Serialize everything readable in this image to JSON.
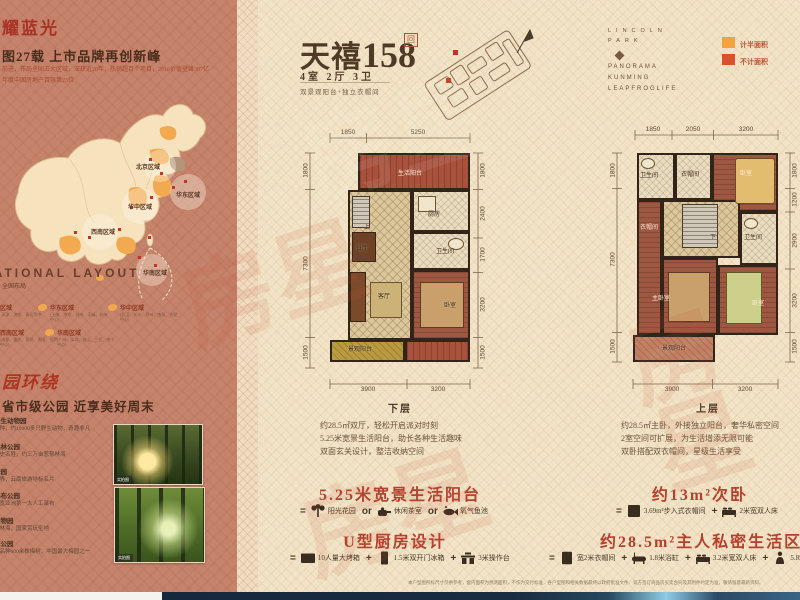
{
  "sidebar": {
    "brand_heading": "耀蓝光",
    "headline": "图27载 上市品牌再创新峰",
    "subline1": "前进，布局全国五大区域，深耕近20年，热销超百个项目，2016价值登峰307亿",
    "subline2": "年度中国房地产百强第23位",
    "map": {
      "layout_en": "NATIONAL LAYOUT",
      "layout_cn": "全国布局",
      "map_labels": [
        "北京区域",
        "华东区域",
        "华中区域",
        "西南区域",
        "华南区域"
      ],
      "legend": [
        {
          "name": "北京区域",
          "desc": "(北京、天津、济南、青岛等中心)"
        },
        {
          "name": "华东区域",
          "desc": "(上海、南京、苏州、无锡、杭州中心)"
        },
        {
          "name": "华中区域",
          "desc": "(武汉、长沙、郑州、南昌、合肥中心)"
        },
        {
          "name": "西南区域",
          "desc": "(成都、重庆、昆明、贵阳、拉萨中心)"
        },
        {
          "name": "华南区域",
          "desc": "(广州、深圳、佛山、三亚、南宁中心)"
        }
      ]
    },
    "park_script": "园环绕",
    "park_headline": "省市级公园  近享美好周末",
    "parks": [
      {
        "name": "野生动物园",
        "desc": "多种，约10000多只野生动物，奇趣非凡"
      },
      {
        "name": "森林公园",
        "desc": "历史名胜，约三万亩葱郁林海"
      },
      {
        "name": "公园",
        "desc": "世界，云南旅游地标名片"
      },
      {
        "name": "瀑布公园",
        "desc": "米宽亚洲第一大人工瀑布"
      },
      {
        "name": "植物园",
        "desc": "杏林海，国家赏玩圣地"
      },
      {
        "name": "潭公园",
        "desc": "个品种600余株梅树，中国最大梅园之一"
      }
    ],
    "photo_tag": "实拍图"
  },
  "main": {
    "title": "天禧",
    "title_num": "158",
    "seal": "回",
    "spec": "4室 2厅 3卫",
    "tagline": "双景观阳台+独立衣帽间",
    "brand": {
      "top1": "LINCOLN",
      "top2": "PARK",
      "line1": "PANORAMA",
      "line2": "KUNMING",
      "line3": "LEAPFROGLIFE"
    },
    "area_legend": [
      {
        "label": "计半面积",
        "color": "#f2a33c"
      },
      {
        "label": "不计面积",
        "color": "#d8502c"
      }
    ],
    "plans": [
      {
        "floor_label": "下层",
        "dims_top": [
          "1850",
          "5250"
        ],
        "dims_left": [
          "1800",
          "7300",
          "1500"
        ],
        "dims_right": [
          "1800",
          "2400",
          "1700",
          "3200",
          "1500"
        ],
        "dims_bottom": [
          "3900",
          "3200"
        ],
        "rooms": [
          "生活阳台",
          "厨房",
          "卫生间",
          "餐厅",
          "客厅",
          "卧室",
          "景观阳台",
          "上"
        ],
        "desc1": "约28.5㎡双厅，轻松开启派对时刻",
        "desc2": "5.25米宽景生活阳台，助长各种生活趣味",
        "desc3": "双面玄关设计，整洁收纳空间"
      },
      {
        "floor_label": "上层",
        "dims_top": [
          "1850",
          "2050",
          "3200"
        ],
        "dims_left": [
          "1800",
          "7300",
          "1500"
        ],
        "dims_right": [
          "1800",
          "1200",
          "2900",
          "3200",
          "1500"
        ],
        "dims_bottom": [
          "3900",
          "3200"
        ],
        "rooms": [
          "卫生间",
          "衣帽间",
          "卧室",
          "衣帽间",
          "下",
          "卫生间",
          "主卧室",
          "卧室",
          "景观阳台"
        ],
        "desc1": "约28.5㎡主卧，外接独立阳台，奢华私密空间",
        "desc2": "2室空间可扩展，为生活增添无限可能",
        "desc3": "双卧搭配双衣帽间，星级生活享受"
      }
    ],
    "features": [
      {
        "heading": "5.25米宽景生活阳台",
        "eq": "=",
        "op": "or",
        "items": [
          {
            "icon": "plant-icon",
            "label": "阳光花园"
          },
          {
            "icon": "teapot-icon",
            "label": "休闲茶室"
          },
          {
            "icon": "fish-icon",
            "label": "氧气鱼池"
          }
        ]
      },
      {
        "heading": "U型厨房设计",
        "eq": "=",
        "op": "+",
        "items": [
          {
            "icon": "oven-icon",
            "label": "10人量大烤箱"
          },
          {
            "icon": "fridge-icon",
            "label": "1.5米双开门冰箱"
          },
          {
            "icon": "counter-icon",
            "label": "3米操作台"
          }
        ]
      },
      {
        "heading": "约13m²次卧",
        "eq": "=",
        "op": "+",
        "items": [
          {
            "icon": "closet-icon",
            "label": "3.69m²步入式衣帽间"
          },
          {
            "icon": "bed-icon",
            "label": "2米宽双人床"
          }
        ]
      },
      {
        "heading": "约28.5m²主人私密生活区",
        "eq": "=",
        "op": "+",
        "items": [
          {
            "icon": "wardrobe-icon",
            "label": "宽2米衣帽间"
          },
          {
            "icon": "bathtub-icon",
            "label": "1.8米浴缸"
          },
          {
            "icon": "bed-icon",
            "label": "3.2米宽双人床"
          },
          {
            "icon": "person-icon",
            "label": "5.85m²私人空间"
          }
        ]
      }
    ],
    "disclaimer": "本户型图所标尺寸仅供参考，套内面积为预测面积，不作为交付标准，各户型图和相关数据最终以政府批准文件、双方签订商品房买卖合同及其附件约定为准，敬请留意最新资料。"
  },
  "watermark": "房星"
}
